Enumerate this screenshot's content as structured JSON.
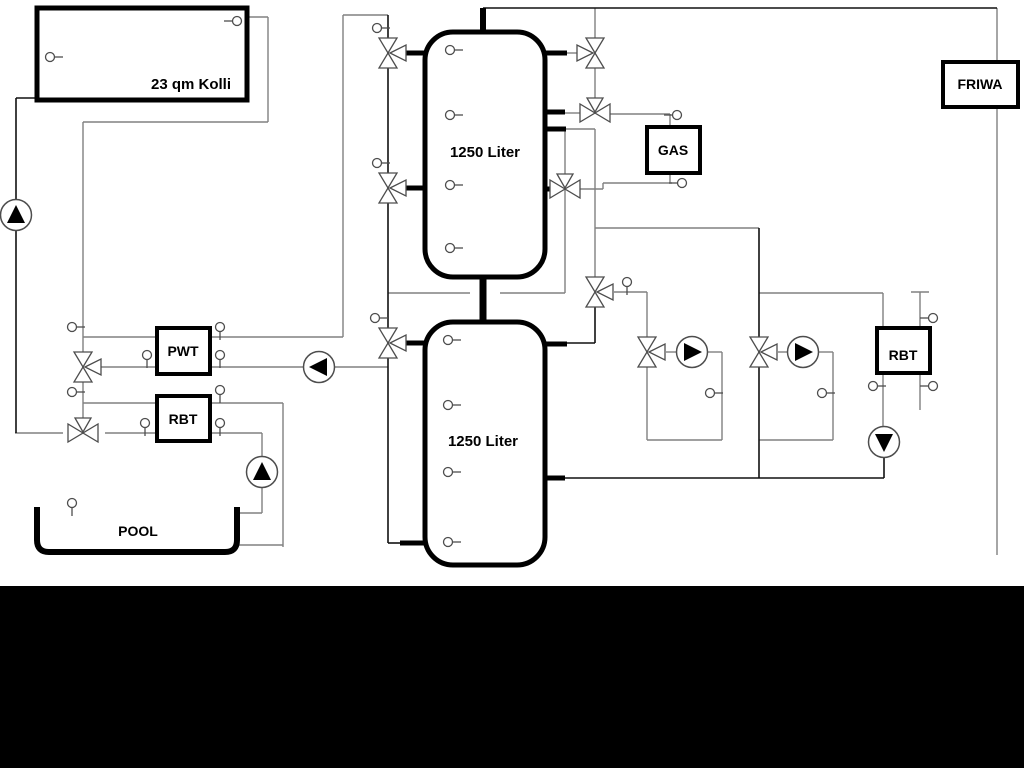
{
  "diagram": {
    "title": "Heating system schematic",
    "colors": {
      "pipe_gray": "#808080",
      "pipe_black": "#111111",
      "stub_black": "#000000",
      "symbol_stroke": "#4d4d4d",
      "background": "#ffffff",
      "band": "#000000"
    },
    "labels": {
      "collector": "23 qm Kolli",
      "tank1": "1250 Liter",
      "tank2": "1250 Liter",
      "pwt": "PWT",
      "rbt_left": "RBT",
      "gas": "GAS",
      "friwa": "FRIWA",
      "rbt_right": "RBT",
      "pool": "POOL"
    },
    "boxes": [
      {
        "id": "collector",
        "bind": "collector",
        "x": 37,
        "y": 8,
        "w": 210,
        "h": 92,
        "sw": 5,
        "tx": 191,
        "ty": 89,
        "fs": 15
      },
      {
        "id": "pwt",
        "bind": "pwt",
        "x": 157,
        "y": 328,
        "w": 53,
        "h": 46,
        "sw": 4,
        "tx": 183,
        "ty": 356,
        "fs": 14
      },
      {
        "id": "rbt-left",
        "bind": "rbt_left",
        "x": 157,
        "y": 396,
        "w": 53,
        "h": 45,
        "sw": 4,
        "tx": 183,
        "ty": 424,
        "fs": 14
      },
      {
        "id": "gas",
        "bind": "gas",
        "x": 647,
        "y": 127,
        "w": 53,
        "h": 46,
        "sw": 4,
        "tx": 673,
        "ty": 155,
        "fs": 14
      },
      {
        "id": "friwa",
        "bind": "friwa",
        "x": 943,
        "y": 62,
        "w": 75,
        "h": 45,
        "sw": 4,
        "tx": 980,
        "ty": 89,
        "fs": 14
      },
      {
        "id": "rbt-right",
        "bind": "rbt_right",
        "x": 877,
        "y": 328,
        "w": 53,
        "h": 45,
        "sw": 4,
        "tx": 903,
        "ty": 360,
        "fs": 14
      }
    ],
    "tanks": [
      {
        "id": "tank1",
        "bind": "tank1",
        "x": 425,
        "y": 32,
        "w": 120,
        "h": 245,
        "r": 28,
        "tx": 485,
        "ty": 157
      },
      {
        "id": "tank2",
        "bind": "tank2",
        "x": 425,
        "y": 322,
        "w": 120,
        "h": 243,
        "r": 28,
        "tx": 483,
        "ty": 446
      }
    ],
    "pool": {
      "bind": "pool",
      "x": 37,
      "y": 507,
      "w": 200,
      "h": 45,
      "tx": 138,
      "ty": 536
    },
    "gray_lines": [
      {
        "o": "h",
        "x": 247,
        "y": 17,
        "l": 21
      },
      {
        "o": "v",
        "x": 268,
        "y": 17,
        "l": 105
      },
      {
        "o": "h",
        "x": 83,
        "y": 122,
        "l": 185
      },
      {
        "o": "v",
        "x": 83,
        "y": 122,
        "l": 311
      },
      {
        "o": "h",
        "x": 343,
        "y": 15,
        "l": 45
      },
      {
        "o": "v",
        "x": 343,
        "y": 15,
        "l": 322
      },
      {
        "o": "h",
        "x": 83,
        "y": 337,
        "l": 74
      },
      {
        "o": "h",
        "x": 210,
        "y": 337,
        "l": 133
      },
      {
        "o": "h",
        "x": 100,
        "y": 367,
        "l": 57
      },
      {
        "o": "h",
        "x": 210,
        "y": 367,
        "l": 178
      },
      {
        "o": "h",
        "x": 83,
        "y": 403,
        "l": 74
      },
      {
        "o": "h",
        "x": 210,
        "y": 403,
        "l": 73
      },
      {
        "o": "v",
        "x": 283,
        "y": 403,
        "l": 144
      },
      {
        "o": "h",
        "x": 237,
        "y": 545,
        "l": 46
      },
      {
        "o": "h",
        "x": 15,
        "y": 433,
        "l": 48
      },
      {
        "o": "h",
        "x": 105,
        "y": 433,
        "l": 52
      },
      {
        "o": "h",
        "x": 210,
        "y": 433,
        "l": 52
      },
      {
        "o": "v",
        "x": 262,
        "y": 433,
        "l": 80
      },
      {
        "o": "h",
        "x": 240,
        "y": 513,
        "l": 22
      },
      {
        "o": "h",
        "x": 388,
        "y": 293,
        "l": 82
      },
      {
        "o": "h",
        "x": 500,
        "y": 293,
        "l": 65
      },
      {
        "o": "v",
        "x": 565,
        "y": 129,
        "l": 164
      },
      {
        "o": "h",
        "x": 566,
        "y": 129,
        "l": 29
      },
      {
        "o": "v",
        "x": 595,
        "y": 129,
        "l": 149
      },
      {
        "o": "h",
        "x": 595,
        "y": 228,
        "l": 164
      },
      {
        "o": "h",
        "x": 614,
        "y": 292,
        "l": 33
      },
      {
        "o": "v",
        "x": 647,
        "y": 292,
        "l": 46
      },
      {
        "o": "v",
        "x": 647,
        "y": 366,
        "l": 74
      },
      {
        "o": "h",
        "x": 647,
        "y": 440,
        "l": 75
      },
      {
        "o": "v",
        "x": 722,
        "y": 352,
        "l": 88
      },
      {
        "o": "h",
        "x": 666,
        "y": 352,
        "l": 11
      },
      {
        "o": "h",
        "x": 707,
        "y": 352,
        "l": 15
      },
      {
        "o": "h",
        "x": 759,
        "y": 440,
        "l": 74
      },
      {
        "o": "v",
        "x": 833,
        "y": 352,
        "l": 88
      },
      {
        "o": "h",
        "x": 778,
        "y": 352,
        "l": 11
      },
      {
        "o": "h",
        "x": 817,
        "y": 352,
        "l": 16
      },
      {
        "o": "h",
        "x": 759,
        "y": 293,
        "l": 124
      },
      {
        "o": "v",
        "x": 883,
        "y": 293,
        "l": 35
      },
      {
        "o": "v",
        "x": 883,
        "y": 373,
        "l": 54
      },
      {
        "o": "v",
        "x": 920,
        "y": 292,
        "l": 118
      },
      {
        "o": "h",
        "x": 911,
        "y": 292,
        "l": 18
      },
      {
        "o": "v",
        "x": 997,
        "y": 8,
        "l": 547
      },
      {
        "o": "h",
        "x": 610,
        "y": 114,
        "l": 60
      },
      {
        "o": "v",
        "x": 670,
        "y": 114,
        "l": 13
      },
      {
        "o": "v",
        "x": 670,
        "y": 173,
        "l": 10
      },
      {
        "o": "h",
        "x": 603,
        "y": 183,
        "l": 69
      },
      {
        "o": "v",
        "x": 603,
        "y": 183,
        "l": 6
      },
      {
        "o": "h",
        "x": 580,
        "y": 189,
        "l": 23
      },
      {
        "o": "h",
        "x": 567,
        "y": 53,
        "l": 15
      },
      {
        "o": "v",
        "x": 595,
        "y": 8,
        "l": 31
      },
      {
        "o": "v",
        "x": 595,
        "y": 67,
        "l": 32
      },
      {
        "o": "h",
        "x": 565,
        "y": 113,
        "l": 15
      }
    ],
    "black_lines": [
      {
        "o": "h",
        "x": 483,
        "y": 8,
        "l": 514
      },
      {
        "o": "v",
        "x": 16,
        "y": 98,
        "l": 335
      },
      {
        "o": "h",
        "x": 16,
        "y": 98,
        "l": 21
      },
      {
        "o": "v",
        "x": 388,
        "y": 15,
        "l": 528
      },
      {
        "o": "h",
        "x": 388,
        "y": 543,
        "l": 14
      },
      {
        "o": "v",
        "x": 595,
        "y": 306,
        "l": 37
      },
      {
        "o": "h",
        "x": 567,
        "y": 343,
        "l": 28
      },
      {
        "o": "h",
        "x": 565,
        "y": 478,
        "l": 319
      },
      {
        "o": "v",
        "x": 884,
        "y": 457,
        "l": 21
      },
      {
        "o": "v",
        "x": 759,
        "y": 228,
        "l": 250
      }
    ],
    "thick_stubs": [
      {
        "o": "h",
        "x": 403,
        "y": 53,
        "l": 22
      },
      {
        "o": "h",
        "x": 403,
        "y": 188,
        "l": 22
      },
      {
        "o": "h",
        "x": 403,
        "y": 343,
        "l": 22
      },
      {
        "o": "h",
        "x": 400,
        "y": 543,
        "l": 25
      },
      {
        "o": "h",
        "x": 545,
        "y": 53,
        "l": 22
      },
      {
        "o": "h",
        "x": 545,
        "y": 112,
        "l": 20
      },
      {
        "o": "h",
        "x": 545,
        "y": 129,
        "l": 21
      },
      {
        "o": "h",
        "x": 545,
        "y": 189,
        "l": 8
      },
      {
        "o": "h",
        "x": 545,
        "y": 344,
        "l": 22
      },
      {
        "o": "h",
        "x": 545,
        "y": 478,
        "l": 20
      },
      {
        "o": "v",
        "x": 483,
        "y": 8,
        "l": 26,
        "w": 6
      },
      {
        "o": "v",
        "x": 483,
        "y": 277,
        "l": 45,
        "w": 7
      }
    ],
    "valves": [
      {
        "x": 388,
        "y": 53,
        "axis": "v",
        "third": "left-facing"
      },
      {
        "x": 388,
        "y": 188,
        "axis": "v",
        "third": "left-facing"
      },
      {
        "x": 388,
        "y": 343,
        "axis": "v",
        "third": "left-facing"
      },
      {
        "x": 83,
        "y": 367,
        "axis": "v",
        "third": "left-facing"
      },
      {
        "x": 595,
        "y": 53,
        "axis": "v",
        "third": "right-facing"
      },
      {
        "x": 595,
        "y": 113,
        "axis": "h",
        "third": "down-facing"
      },
      {
        "x": 565,
        "y": 189,
        "axis": "h",
        "third": "down-facing"
      },
      {
        "x": 83,
        "y": 433,
        "axis": "h",
        "third": "down-facing"
      },
      {
        "x": 595,
        "y": 292,
        "axis": "v",
        "third": "left-facing"
      },
      {
        "x": 647,
        "y": 352,
        "axis": "v",
        "third": "left-facing"
      },
      {
        "x": 759,
        "y": 352,
        "axis": "v",
        "third": "left-facing"
      }
    ],
    "pumps": [
      {
        "x": 16,
        "y": 215,
        "dir": "up"
      },
      {
        "x": 319,
        "y": 367,
        "dir": "left"
      },
      {
        "x": 262,
        "y": 472,
        "dir": "up"
      },
      {
        "x": 692,
        "y": 352,
        "dir": "right"
      },
      {
        "x": 803,
        "y": 352,
        "dir": "right"
      },
      {
        "x": 884,
        "y": 442,
        "dir": "down"
      }
    ],
    "sensors": [
      {
        "x": 50,
        "y": 57,
        "stem": "right"
      },
      {
        "x": 237,
        "y": 21,
        "stem": "left"
      },
      {
        "x": 450,
        "y": 50,
        "stem": "right"
      },
      {
        "x": 450,
        "y": 115,
        "stem": "right"
      },
      {
        "x": 450,
        "y": 185,
        "stem": "right"
      },
      {
        "x": 450,
        "y": 248,
        "stem": "right"
      },
      {
        "x": 448,
        "y": 340,
        "stem": "right"
      },
      {
        "x": 448,
        "y": 405,
        "stem": "right"
      },
      {
        "x": 448,
        "y": 472,
        "stem": "right"
      },
      {
        "x": 448,
        "y": 542,
        "stem": "right"
      },
      {
        "x": 377,
        "y": 28,
        "stem": "right"
      },
      {
        "x": 377,
        "y": 163,
        "stem": "right"
      },
      {
        "x": 375,
        "y": 318,
        "stem": "right"
      },
      {
        "x": 72,
        "y": 327,
        "stem": "right"
      },
      {
        "x": 220,
        "y": 327,
        "stem": "down"
      },
      {
        "x": 147,
        "y": 355,
        "stem": "down"
      },
      {
        "x": 220,
        "y": 355,
        "stem": "down"
      },
      {
        "x": 72,
        "y": 392,
        "stem": "right"
      },
      {
        "x": 220,
        "y": 390,
        "stem": "down"
      },
      {
        "x": 145,
        "y": 423,
        "stem": "down"
      },
      {
        "x": 220,
        "y": 423,
        "stem": "down"
      },
      {
        "x": 72,
        "y": 503,
        "stem": "down"
      },
      {
        "x": 627,
        "y": 282,
        "stem": "down"
      },
      {
        "x": 677,
        "y": 115,
        "stem": "left"
      },
      {
        "x": 682,
        "y": 183,
        "stem": "left"
      },
      {
        "x": 710,
        "y": 393,
        "stem": "right"
      },
      {
        "x": 822,
        "y": 393,
        "stem": "right"
      },
      {
        "x": 873,
        "y": 386,
        "stem": "right"
      },
      {
        "x": 933,
        "y": 318,
        "stem": "left"
      },
      {
        "x": 933,
        "y": 386,
        "stem": "left"
      }
    ],
    "bottom_band": {
      "x": 0,
      "y": 586,
      "w": 1024,
      "h": 182
    }
  }
}
